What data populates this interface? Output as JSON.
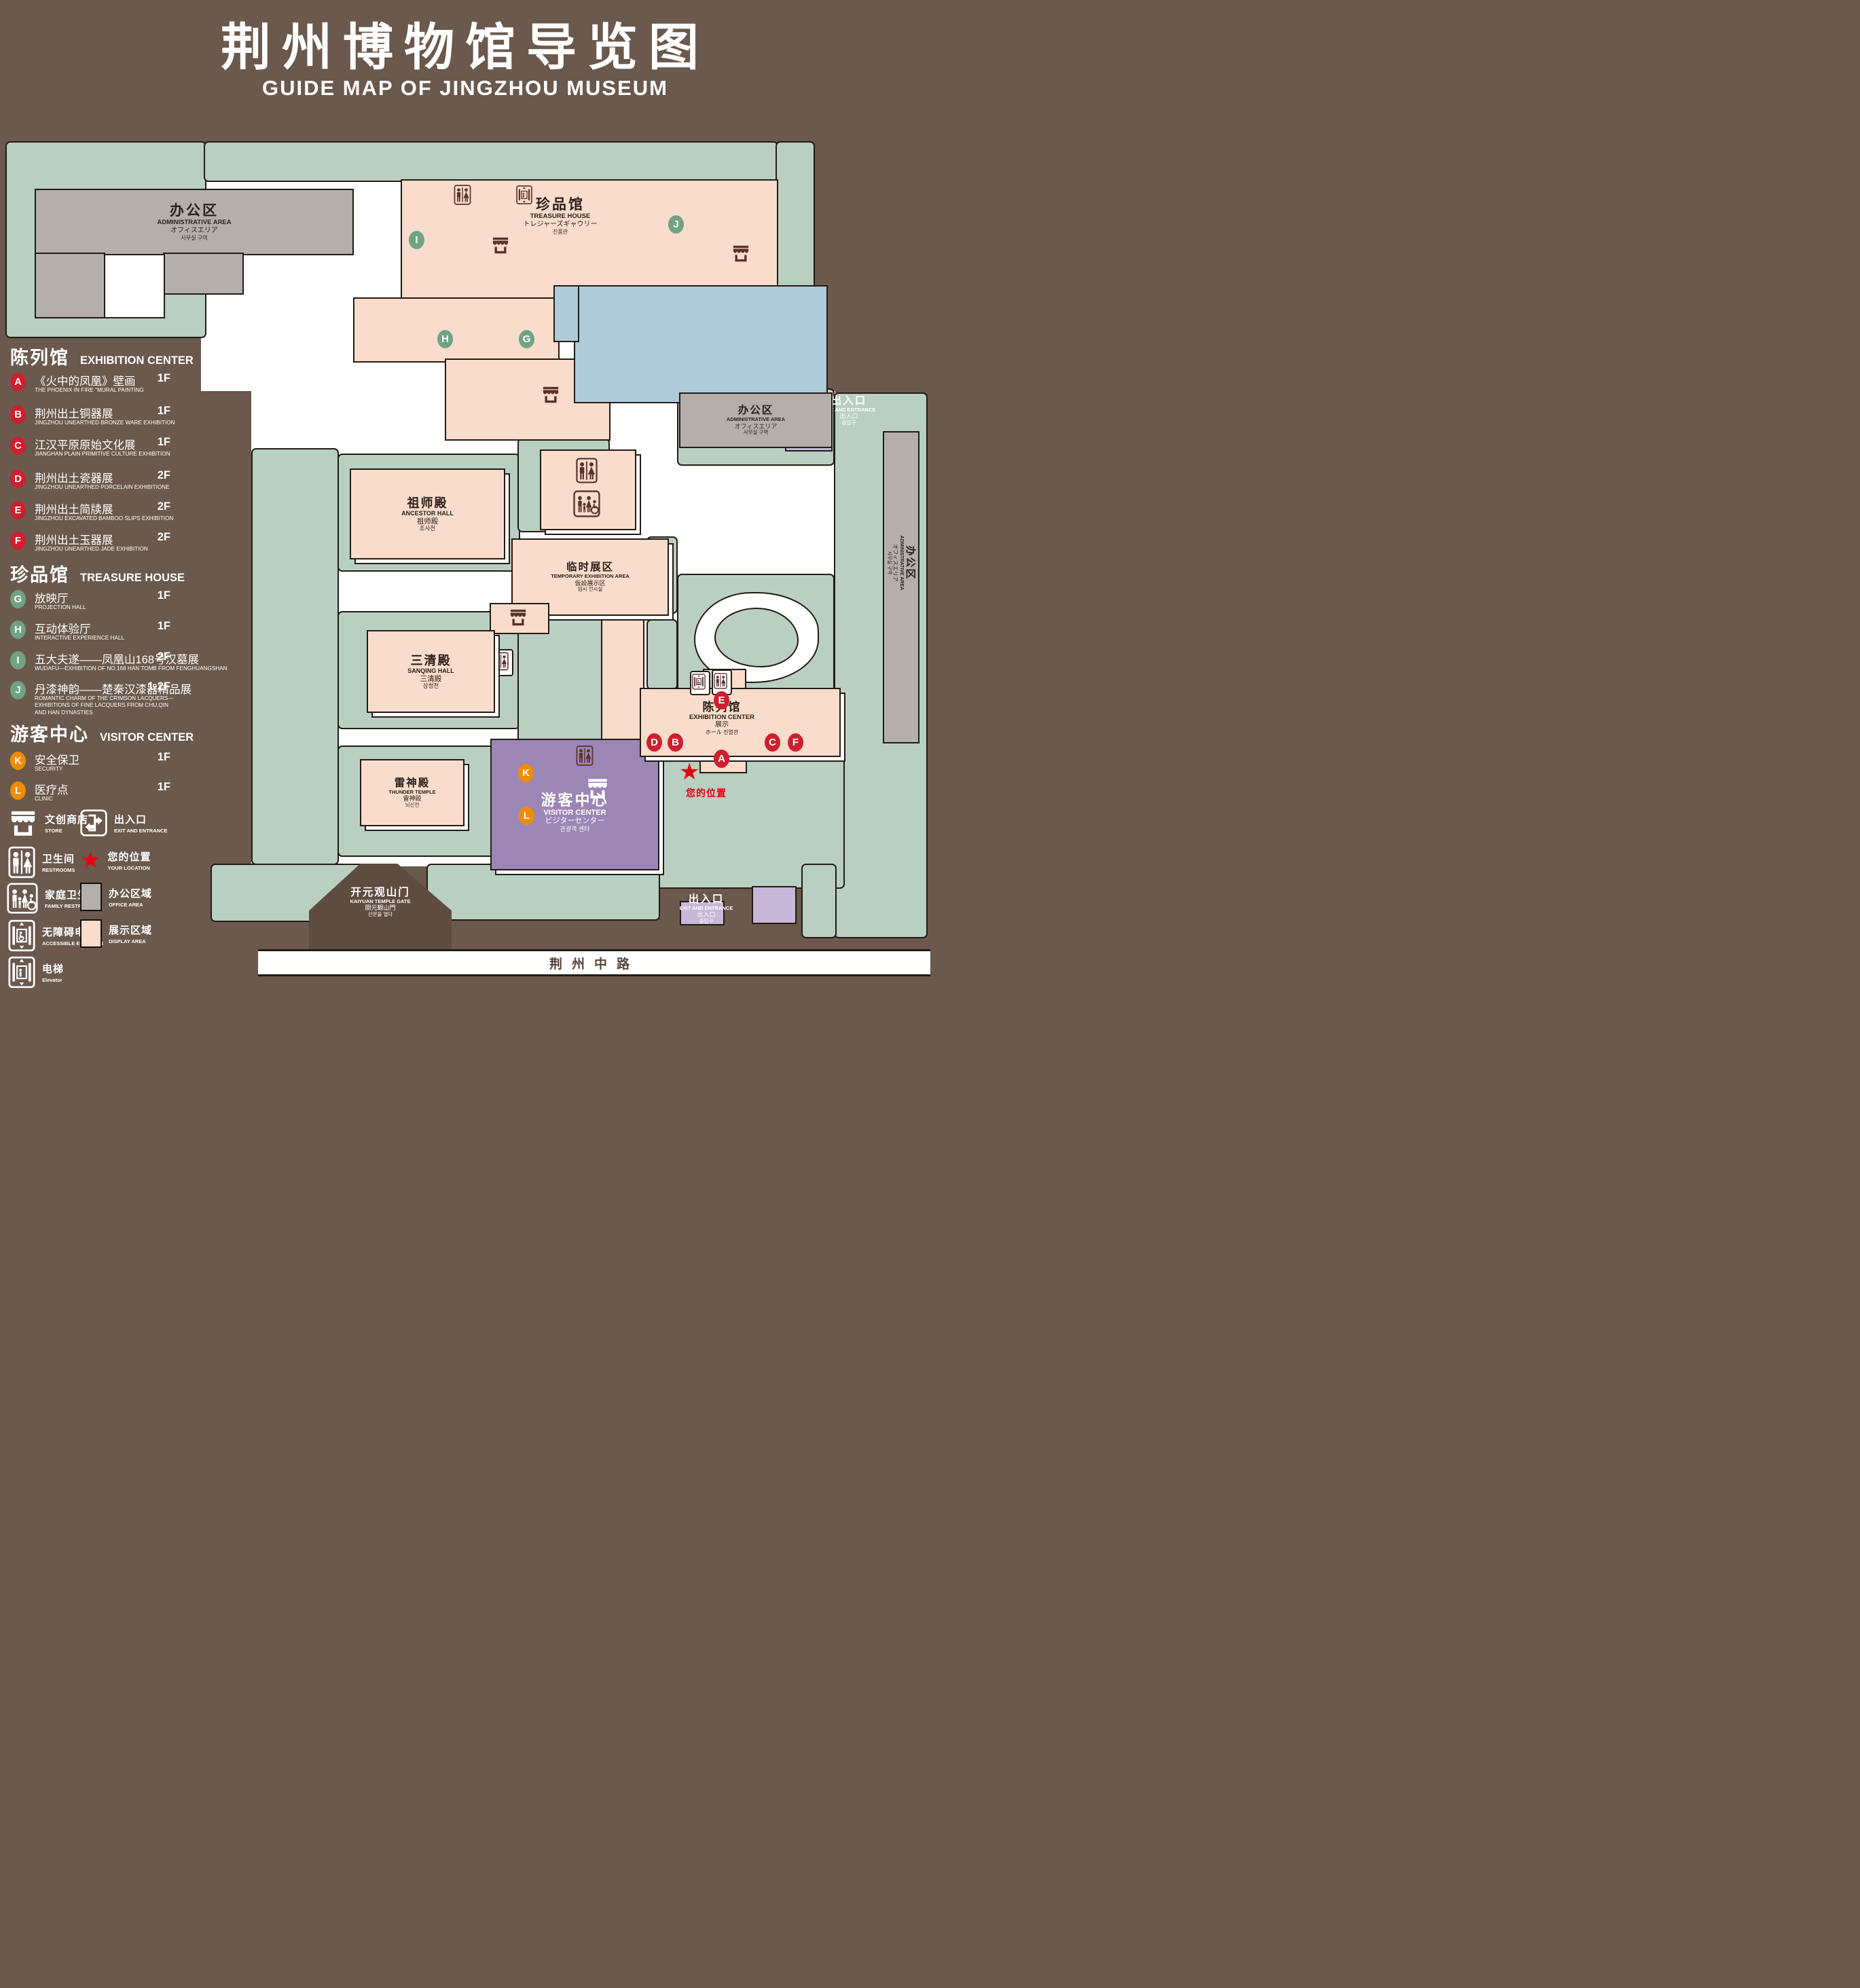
{
  "title": {
    "zh": "荆州博物馆导览图",
    "en": "GUIDE MAP OF JINGZHOU MUSEUM"
  },
  "legend": {
    "sections": [
      {
        "zh": "陈列馆",
        "en": "EXHIBITION CENTER",
        "items": [
          {
            "letter": "A",
            "zh": "《火中的凤凰》壁画",
            "en": "THE PHOENIX IN FIRE \"MURAL PAINTING",
            "floor": "1F"
          },
          {
            "letter": "B",
            "zh": "荆州出土铜器展",
            "en": "JINGZHOU UNEARTHED BRONZE WARE EXHIBITION",
            "floor": "1F"
          },
          {
            "letter": "C",
            "zh": "江汉平原原始文化展",
            "en": "JIANGHAN PLAIN PRIMITIVE CULTURE EXHIBITION",
            "floor": "1F"
          },
          {
            "letter": "D",
            "zh": "荆州出土瓷器展",
            "en": "JINGZHOU UNEARTHED PORCELAIN EXHIBITIONE",
            "floor": "2F"
          },
          {
            "letter": "E",
            "zh": "荆州出土简牍展",
            "en": "JINGZHOU EXCAVATED BAMBOO SLIPS EXHIBITION",
            "floor": "2F"
          },
          {
            "letter": "F",
            "zh": "荆州出土玉器展",
            "en": "JINGZHOU UNEARTHED JADE EXHIBITION",
            "floor": "2F"
          }
        ]
      },
      {
        "zh": "珍品馆",
        "en": "TREASURE HOUSE",
        "items": [
          {
            "letter": "G",
            "zh": "放映厅",
            "en": "PROJECTION HALL",
            "floor": "1F"
          },
          {
            "letter": "H",
            "zh": "互动体验厅",
            "en": "INTERACTIVE EXPERIENCE HALL",
            "floor": "1F"
          },
          {
            "letter": "I",
            "zh": "五大夫遂——凤凰山168号汉墓展",
            "en": "WUDAFU—EXHIBITION OF NO.168 HAN TOMB FROM FENGHUANGSHAN",
            "floor": "2F"
          },
          {
            "letter": "J",
            "zh": "丹漆神韵——楚秦汉漆器精品展",
            "en": "ROMANTIC CHARM OF THE CRIMSON LACQUERS—EXHIBITIONS OF FINE LACQUERS FROM CHU,QIN AND HAN DYNASTIES",
            "floor": "1-2F"
          }
        ]
      },
      {
        "zh": "游客中心",
        "en": "VISITOR CENTER",
        "items": [
          {
            "letter": "K",
            "zh": "安全保卫",
            "en": "SECURITY",
            "floor": "1F"
          },
          {
            "letter": "L",
            "zh": "医疗点",
            "en": "CLINIC",
            "floor": "1F"
          }
        ]
      }
    ],
    "symbols": [
      {
        "icon": "store-icon",
        "zh": "文创商店",
        "en": "STORE"
      },
      {
        "icon": "exit-icon",
        "zh": "出入口",
        "en": "EXIT AND ENTRANCE"
      },
      {
        "icon": "restroom-icon",
        "zh": "卫生间",
        "en": "RESTROOMS"
      },
      {
        "icon": "location-star-icon",
        "zh": "您的位置",
        "en": "YOUR LOCATION"
      },
      {
        "icon": "family-restroom-icon",
        "zh": "家庭卫生间",
        "en": "FAMILY RESTROOMS"
      },
      {
        "icon": "office-area-swatch",
        "zh": "办公区域",
        "en": "OFFICE AREA"
      },
      {
        "icon": "accessible-elevator-icon",
        "zh": "无障碍电梯",
        "en": "ACCESSIBLE ELEVATOR"
      },
      {
        "icon": "display-area-swatch",
        "zh": "展示区域",
        "en": "DISPLAY AREA"
      },
      {
        "icon": "elevator-icon",
        "zh": "电梯",
        "en": "Elevator"
      }
    ]
  },
  "map": {
    "buildings": {
      "admin_top_left": {
        "lines": [
          "办公区",
          "ADMINISTRATIVE AREA",
          "オフィスエリア",
          "사무실 구역"
        ]
      },
      "treasure_house": {
        "lines": [
          "珍品馆",
          "TREASURE HOUSE",
          "トレジャーズギャウリー",
          "진품관"
        ]
      },
      "exit_top_right": {
        "lines": [
          "出入口",
          "EXIT AND ENTRANCE",
          "出入口",
          "출입구"
        ]
      },
      "admin_right": {
        "lines": [
          "办公区",
          "ADMINISTRATIVE AREA",
          "オフィスエリア",
          "사무실 구역"
        ]
      },
      "admin_far_right": {
        "lines": [
          "办公区",
          "ADMINISTRATIVE AREA",
          "オフィスエリア",
          "사무실 구역"
        ]
      },
      "ancestor_hall": {
        "lines": [
          "祖师殿",
          "ANCESTOR HALL",
          "祖师殿",
          "조사전"
        ]
      },
      "temporary_exhibition": {
        "lines": [
          "临时展区",
          "TEMPORARY EXHIBITION AREA",
          "仮設展示区",
          "임시 전시실"
        ]
      },
      "sanqing_hall": {
        "lines": [
          "三清殿",
          "SANQING HALL",
          "三清殿",
          "삼청전"
        ]
      },
      "thunder_temple": {
        "lines": [
          "雷神殿",
          "THUNDER TEMPLE",
          "雷神殿",
          "뇌신전"
        ]
      },
      "visitor_center": {
        "lines": [
          "游客中心",
          "VISITOR CENTER",
          "ビジターセンター",
          "관광객 센터"
        ]
      },
      "exhibition_center": {
        "lines": [
          "陈列馆",
          "EXHIBITION CENTER",
          "展示",
          "ホール 진열관"
        ]
      },
      "kaiyuan_gate": {
        "lines": [
          "开元观山门",
          "KAIYUAN TEMPLE GATE",
          "開元観山門",
          "산문을 열다"
        ]
      },
      "exit_bottom": {
        "lines": [
          "出入口",
          "EXIT AND ENTRANCE",
          "出入口",
          "출입구"
        ]
      }
    },
    "road_label": "荆州中路",
    "your_location_label": "您的位置",
    "markers": [
      {
        "letter": "I"
      },
      {
        "letter": "J"
      },
      {
        "letter": "H"
      },
      {
        "letter": "G"
      },
      {
        "letter": "E"
      },
      {
        "letter": "D"
      },
      {
        "letter": "B"
      },
      {
        "letter": "C"
      },
      {
        "letter": "F"
      },
      {
        "letter": "A"
      },
      {
        "letter": "K"
      },
      {
        "letter": "L"
      }
    ]
  },
  "colors": {
    "background": "#6a594c",
    "lawn": "#b9cfc1",
    "display_area": "#f9dccb",
    "office_area": "#b4afab",
    "pond": "#aecbd9",
    "visitor_center": "#9c86b5",
    "gate_block": "#c8b7d8",
    "marker_red": "#cf1f2e",
    "marker_green": "#6fa383",
    "marker_orange": "#f08c00",
    "icon_brown": "#5a322b",
    "location_red": "#e8000d",
    "outline": "#231b15"
  }
}
